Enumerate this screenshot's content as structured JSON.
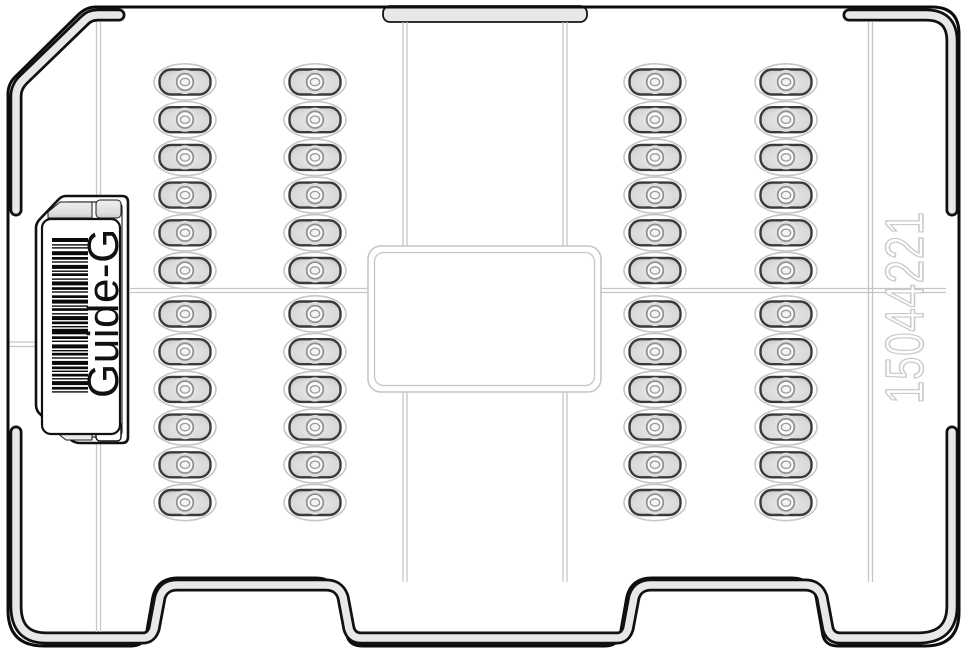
{
  "diagram": {
    "kind": "tray-cassette-illustration",
    "label": {
      "text": "Guide-G"
    },
    "serial": {
      "text": "15044221"
    },
    "colors": {
      "outline": "#0d0d0d",
      "wall_fill": "#e8e8e8",
      "panel_line": "#c6c6c6",
      "serial_outline": "#c9c9c9",
      "well_border": "#3a3a3a",
      "well_fill_edge": "#c6c6c6",
      "well_fill_center": "#e8e8e8",
      "well_halo": "#c6c6c6",
      "well_ring": "#8f8f8f"
    },
    "wells": {
      "column_centers_x": [
        185,
        315,
        655,
        786
      ],
      "rows_per_bank": 6,
      "banks": 2,
      "row_step": 37.7,
      "top_bank_start_y": 82,
      "bottom_bank_start_y": 314
    },
    "barcode": {
      "x": 52,
      "width": 36,
      "start_y": 238,
      "pattern": [
        4,
        2.2,
        1.4,
        1.6,
        1.4,
        2.6,
        4,
        1.8,
        2.7,
        1.6,
        1.4,
        2.2,
        4,
        1.6,
        1.4,
        1.4,
        2.7,
        2.4,
        1.4,
        1.6,
        4,
        1.8,
        2.7,
        1.4,
        1.4,
        2.6,
        2.7,
        1.6,
        4,
        1.8,
        1.4,
        1.4,
        2.7,
        2.2,
        1.4,
        1.6,
        4,
        1.4,
        2.7,
        1.8,
        1.4,
        1.4,
        5.5,
        2,
        2.7,
        1.6,
        1.4,
        2.4,
        4,
        1.6,
        1.4,
        1.4,
        2.7,
        1.8,
        1.4,
        2.2,
        4,
        1.6,
        2.7,
        1.4,
        1.4,
        1.8,
        2.7,
        1.6,
        1.4,
        1.6,
        4,
        1.8,
        2.7,
        1.6,
        1.4,
        0
      ]
    }
  }
}
